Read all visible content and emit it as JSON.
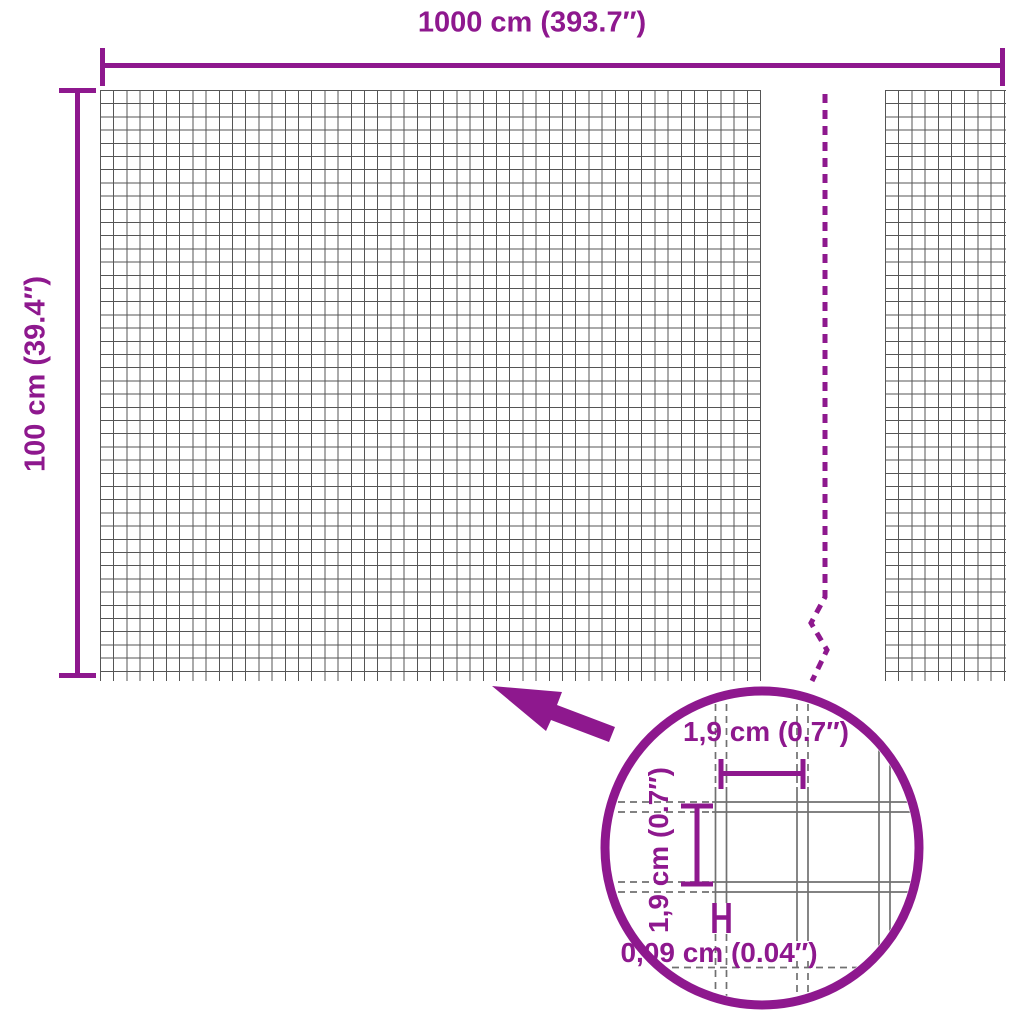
{
  "colors": {
    "accent": "#8E188E",
    "mesh": "#555555",
    "wire": "#707070",
    "bg": "#ffffff"
  },
  "dimensions": {
    "width": {
      "label": "1000 cm (393.7″)"
    },
    "height": {
      "label": "100 cm (39.4″)"
    }
  },
  "detail": {
    "cell_width_label": "1,9 cm (0.7″)",
    "cell_height_label": "1,9 cm (0.7″)",
    "wire_thickness_label": "0,09 cm (0.04″)"
  }
}
